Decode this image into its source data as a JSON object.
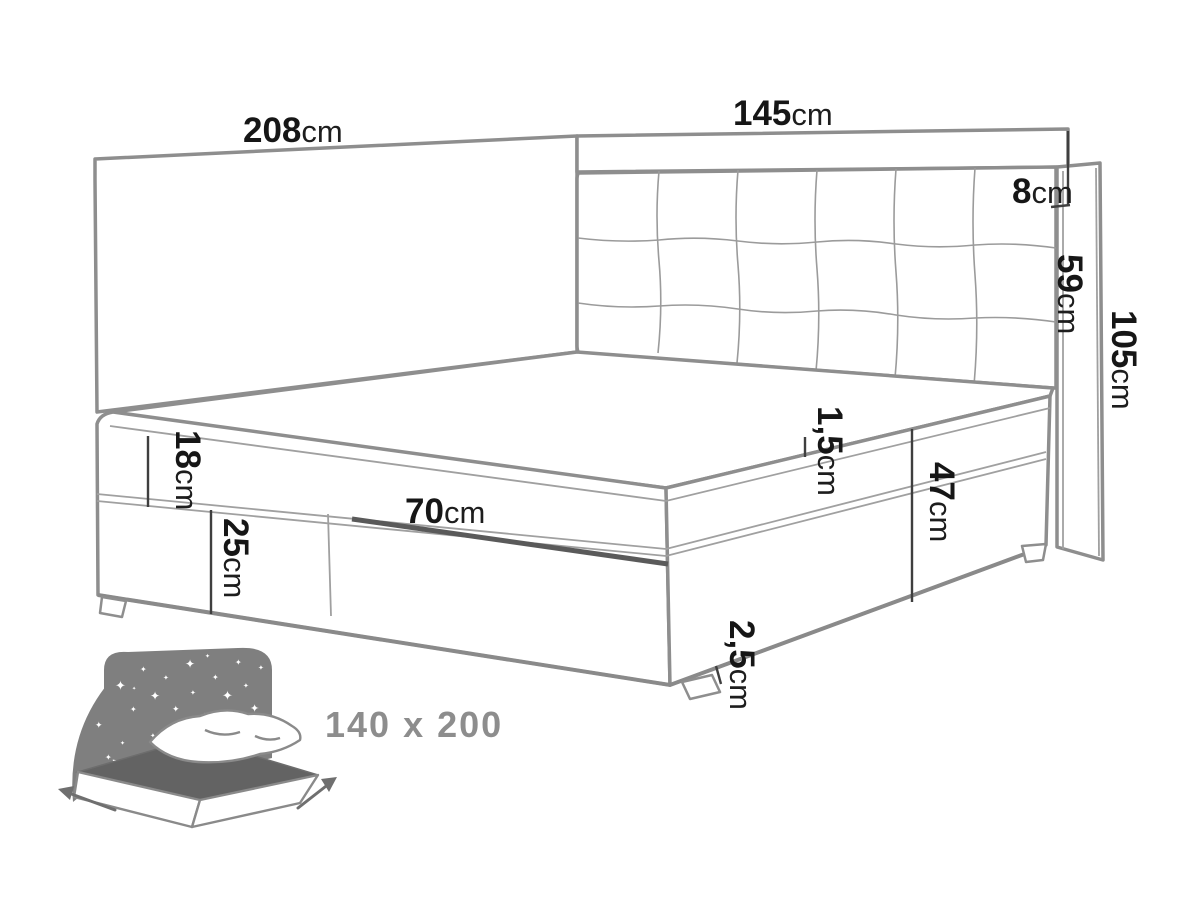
{
  "diagram": {
    "title": "boxspring-bed-dimension-diagram",
    "size_label": "140 x 200",
    "colors": {
      "line_gray": "#8e8e8e",
      "label_black": "#161616",
      "icon_gray": "#7f7f7f",
      "background": "#ffffff"
    },
    "dimensions": {
      "panel_length": {
        "value": "208",
        "unit": "cm"
      },
      "headboard_width": {
        "value": "145",
        "unit": "cm"
      },
      "top_gap": {
        "value": "8",
        "unit": "cm"
      },
      "headboard_height": {
        "value": "59",
        "unit": "cm"
      },
      "total_height": {
        "value": "105",
        "unit": "cm"
      },
      "mattress_height": {
        "value": "18",
        "unit": "cm"
      },
      "box_height": {
        "value": "25",
        "unit": "cm"
      },
      "drawer_width": {
        "value": "70",
        "unit": "cm"
      },
      "seam_gap": {
        "value": "1,5",
        "unit": "cm"
      },
      "base_height": {
        "value": "47",
        "unit": "cm"
      },
      "floor_clearance": {
        "value": "2,5",
        "unit": "cm"
      }
    }
  }
}
